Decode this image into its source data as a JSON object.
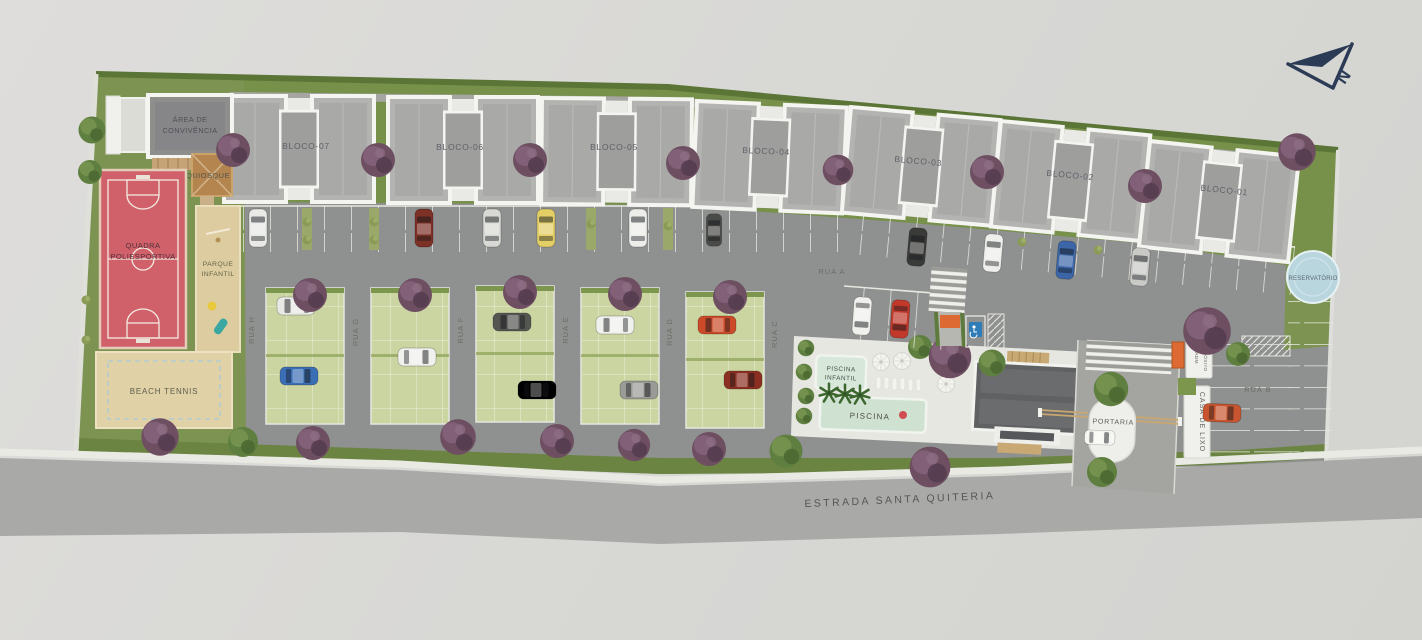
{
  "plan": {
    "compass_letter": "N",
    "road": "ESTRADA SANTA QUITERIA",
    "blocks": [
      "BLOCO-07",
      "BLOCO-06",
      "BLOCO-05",
      "BLOCO-04",
      "BLOCO-03",
      "BLOCO-02",
      "BLOCO-01"
    ],
    "streets": {
      "vertical": [
        "RUA H",
        "RUA G",
        "RUA F",
        "RUA E",
        "RUA D",
        "RUA C"
      ],
      "rua_a": "RUA A",
      "rua_b": "RUA B"
    },
    "amenities": {
      "convivencia_l1": "ÁREA DE",
      "convivencia_l2": "CONVIVÊNCIA",
      "quiosque": "QUIOSQUE",
      "quadra_l1": "QUADRA",
      "quadra_l2": "POLIESPORTIVA",
      "parque_l1": "PARQUE",
      "parque_l2": "INFANTIL",
      "beach_tennis": "BEACH TENNIS",
      "piscina_infantil_l1": "PISCINA",
      "piscina_infantil_l2": "INFANTIL",
      "piscina": "PISCINA",
      "portaria": "PORTARIA",
      "casa_de_lixo": "CASA DE LIXO",
      "adm_l1": "ADM",
      "adm_l2": "DEPÓSITO",
      "reservatorio": "RESERVATÓRIO"
    },
    "colors": {
      "grass": "#7d9352",
      "grass_dark": "#5a7536",
      "asphalt": "#8f9190",
      "road": "#a9a9a7",
      "court_red": "#d0616a",
      "sand": "#dccc9f",
      "beach_sand": "#e0d2a6",
      "paver_green": "#cbd5a2",
      "pool_water": "#cfe2d2",
      "roof_gray": "#b3b3b1",
      "roof_dark": "#5f6163",
      "reservoir_blue": "#b9d5de",
      "tree_purple": "#6e4f62",
      "tree_green": "#5f7f40",
      "accent_orange": "#dd6a33",
      "compass_navy": "#2b3a55"
    }
  }
}
